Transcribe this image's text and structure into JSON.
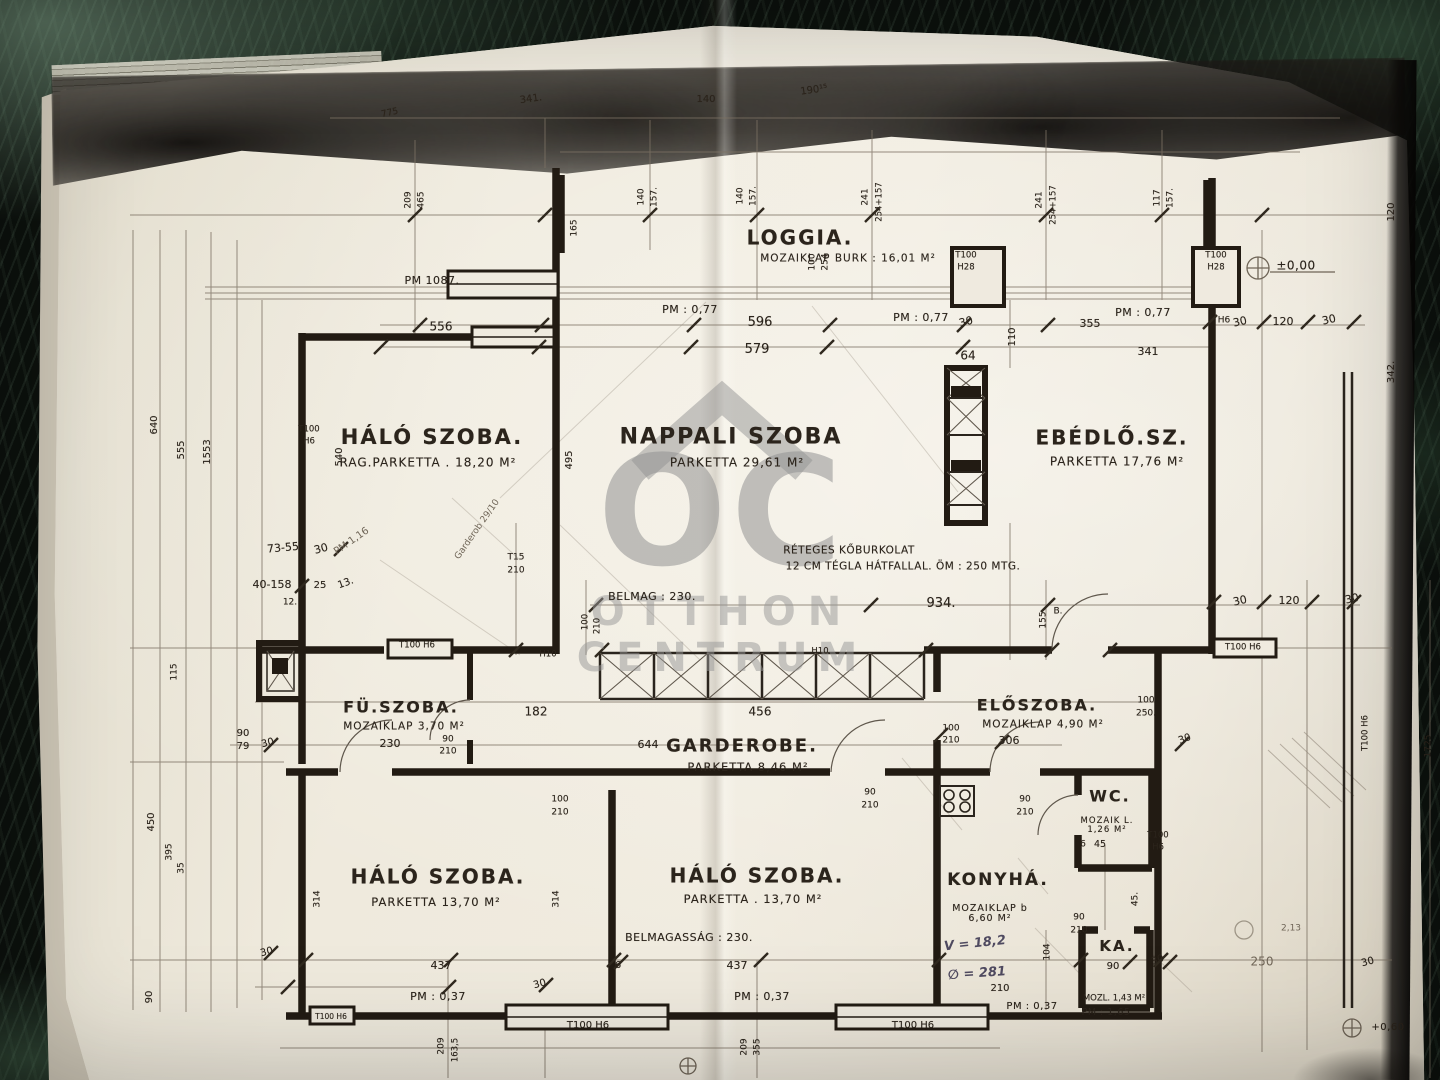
{
  "photo": {
    "surface": "dark green marble table",
    "document": "Hungarian apartment floor plan photocopy",
    "watermark": {
      "initials": "OC",
      "line1": "OTTHON",
      "line2": "CENTRUM"
    }
  },
  "colors": {
    "marble": "#0c110d",
    "paper": "#e9e4d6",
    "ink": "#2b241c",
    "pencil": "#6f6557",
    "handwriting": "#4f4a60",
    "watermark": "#929292"
  },
  "rooms": [
    {
      "name": "LOGGIA.",
      "finish": "MOZAIKLAP BURK : 16,01 M²",
      "nx": 800,
      "ny": 238,
      "ns": 20,
      "fx": 848,
      "fy": 259,
      "fs": 10.5
    },
    {
      "name": "HÁLÓ SZOBA.",
      "finish": "RAG.PARKETTA . 18,20 M²",
      "nx": 432,
      "ny": 437,
      "ns": 21,
      "fx": 428,
      "fy": 463,
      "fs": 12
    },
    {
      "name": "NAPPALI SZOBA",
      "finish": "PARKETTA 29,61 M²",
      "nx": 731,
      "ny": 437,
      "ns": 22,
      "fx": 737,
      "fy": 463,
      "fs": 12
    },
    {
      "name": "EBÉDLŐ.SZ.",
      "finish": "PARKETTA 17,76 M²",
      "nx": 1112,
      "ny": 438,
      "ns": 20,
      "fx": 1117,
      "fy": 462,
      "fs": 12
    },
    {
      "name": "FÜ.SZOBA.",
      "finish": "MOZAIKLAP 3,70 M²",
      "nx": 401,
      "ny": 708,
      "ns": 16,
      "fx": 404,
      "fy": 727,
      "fs": 10.5
    },
    {
      "name": "GARDEROBE.",
      "finish": "PARKETTA 8,46 M²",
      "nx": 742,
      "ny": 747,
      "ns": 18,
      "fx": 748,
      "fy": 767,
      "fs": 11.5
    },
    {
      "name": "ELŐSZOBA.",
      "finish": "MOZAIKLAP 4,90 M²",
      "nx": 1037,
      "ny": 706,
      "ns": 16,
      "fx": 1043,
      "fy": 725,
      "fs": 10.5
    },
    {
      "name": "WC.",
      "finish": "MOZAIK L. 1,26 M²",
      "nx": 1110,
      "ny": 797,
      "ns": 16,
      "fx": 1107,
      "fy": 826,
      "fs": 8.5,
      "fw": 62
    },
    {
      "name": "KONYHÁ.",
      "finish": "MOZAIKLAP b 6,60 M²",
      "nx": 998,
      "ny": 881,
      "ns": 17,
      "fx": 990,
      "fy": 914,
      "fs": 9.5,
      "fw": 86
    },
    {
      "name": "KA.",
      "finish": "",
      "nx": 1117,
      "ny": 947,
      "ns": 15
    },
    {
      "name": "HÁLÓ SZOBA.",
      "finish": "PARKETTA 13,70 M²",
      "nx": 438,
      "ny": 877,
      "ns": 20,
      "fx": 436,
      "fy": 902,
      "fs": 11.5
    },
    {
      "name": "HÁLÓ SZOBA.",
      "finish": "PARKETTA . 13,70 M²",
      "nx": 757,
      "ny": 876,
      "ns": 20,
      "fx": 753,
      "fy": 899,
      "fs": 11.5
    }
  ],
  "notes": [
    [
      "BELMAG : 230.",
      652,
      597,
      11
    ],
    [
      "BELMAGASSÁG : 230.",
      689,
      938,
      11
    ],
    [
      "RÉTEGES KŐBURKOLAT",
      849,
      551,
      10.5
    ],
    [
      "12 CM TÉGLA HÁTFALLAL. ÖM : 250 MTG.",
      903,
      567,
      10.5
    ]
  ],
  "levels": [
    [
      "±0,00",
      1296,
      266,
      12
    ],
    [
      "PM 1087.",
      432,
      281,
      11
    ],
    [
      "PM : 0,77",
      690,
      310,
      11
    ],
    [
      "PM : 0,77",
      921,
      318,
      11
    ],
    [
      "PM : 0,77",
      1143,
      313,
      11
    ],
    [
      "PM : 0,37",
      438,
      997,
      11
    ],
    [
      "PM : 0,37",
      762,
      997,
      11
    ],
    [
      "PM : 0,37",
      1032,
      1007,
      10
    ],
    [
      "PM : 1,65",
      1106,
      1013,
      9.5
    ],
    [
      "+0,60",
      1388,
      1028,
      10
    ]
  ],
  "dims": [
    [
      "596",
      760,
      323,
      13
    ],
    [
      "579",
      757,
      350,
      13
    ],
    [
      "556",
      441,
      327,
      12
    ],
    [
      "934.",
      941,
      604,
      13
    ],
    [
      "456",
      760,
      712,
      12
    ],
    [
      "182",
      536,
      712,
      12
    ],
    [
      "644",
      648,
      745,
      11
    ],
    [
      "230",
      390,
      744,
      11
    ],
    [
      "306",
      1009,
      741,
      11
    ],
    [
      "437",
      441,
      966,
      11
    ],
    [
      "437",
      737,
      966,
      11
    ],
    [
      "64",
      968,
      356,
      12
    ],
    [
      "30",
      966,
      322,
      11,
      -15
    ],
    [
      "355",
      1090,
      324,
      11
    ],
    [
      "341",
      1148,
      352,
      11
    ],
    [
      "110",
      1013,
      337,
      10,
      -90
    ],
    [
      "30",
      1240,
      322,
      11,
      -12
    ],
    [
      "120",
      1283,
      322,
      11
    ],
    [
      "30",
      1329,
      320,
      11,
      -12
    ],
    [
      "30",
      1240,
      601,
      11,
      -12
    ],
    [
      "120",
      1289,
      601,
      11
    ],
    [
      "30",
      1352,
      599,
      11,
      -12
    ],
    [
      "120",
      1392,
      212,
      10,
      -90
    ],
    [
      "342.",
      1392,
      372,
      10,
      -90
    ],
    [
      "341.",
      531,
      100,
      10,
      -8
    ],
    [
      "140",
      706,
      100,
      10
    ],
    [
      "190¹⁵",
      814,
      91,
      10,
      -8
    ],
    [
      "775",
      390,
      114,
      9,
      -12
    ],
    [
      "140",
      642,
      197,
      9,
      -90
    ],
    [
      "157.",
      655,
      197,
      9,
      -90
    ],
    [
      "140",
      741,
      196,
      9,
      -90
    ],
    [
      "157.",
      754,
      196,
      9,
      -90
    ],
    [
      "241",
      866,
      197,
      9,
      -90
    ],
    [
      "254+157",
      880,
      202,
      8.5,
      -90
    ],
    [
      "241",
      1040,
      200,
      9,
      -90
    ],
    [
      "254+157",
      1054,
      205,
      8.5,
      -90
    ],
    [
      "117",
      1158,
      198,
      9,
      -90
    ],
    [
      "157.",
      1171,
      198,
      9,
      -90
    ],
    [
      "209",
      409,
      200,
      9,
      -90
    ],
    [
      "465",
      422,
      200,
      9,
      -90
    ],
    [
      "165",
      575,
      228,
      9,
      -90
    ],
    [
      "100",
      813,
      262,
      9,
      -90
    ],
    [
      "254",
      826,
      262,
      9,
      -90
    ],
    [
      "T100",
      966,
      256,
      8.5
    ],
    [
      "H28",
      966,
      268,
      8.5
    ],
    [
      "T100",
      1216,
      256,
      8.5
    ],
    [
      "H28",
      1216,
      268,
      8.5
    ],
    [
      "H6",
      1224,
      321,
      9
    ],
    [
      "540",
      340,
      457,
      10,
      -90
    ],
    [
      "495",
      570,
      460,
      10,
      -90
    ],
    [
      "640",
      155,
      425,
      10,
      -90
    ],
    [
      "555",
      182,
      450,
      10,
      -90
    ],
    [
      "1553",
      208,
      452,
      10,
      -90
    ],
    [
      "T100",
      309,
      430,
      8.5
    ],
    [
      "H6",
      309,
      442,
      8.5
    ],
    [
      "73-55",
      283,
      548,
      11,
      -5
    ],
    [
      "30",
      321,
      549,
      11,
      -15
    ],
    [
      "40-158",
      272,
      585,
      11
    ],
    [
      "25",
      320,
      586,
      10
    ],
    [
      "13.",
      346,
      584,
      10,
      -20
    ],
    [
      "12.",
      290,
      603,
      9
    ],
    [
      "115",
      175,
      672,
      9,
      -90
    ],
    [
      "450",
      152,
      822,
      10,
      -90
    ],
    [
      "395",
      170,
      852,
      9,
      -90
    ],
    [
      "35",
      182,
      868,
      9,
      -90
    ],
    [
      "90",
      243,
      734,
      10
    ],
    [
      "79",
      243,
      747,
      10
    ],
    [
      "30",
      268,
      744,
      10,
      -15
    ],
    [
      "314",
      318,
      899,
      9,
      -90
    ],
    [
      "314",
      557,
      899,
      9,
      -90
    ],
    [
      "30",
      267,
      953,
      10,
      -15
    ],
    [
      "90",
      150,
      997,
      10,
      -90
    ],
    [
      "209",
      442,
      1046,
      9,
      -90
    ],
    [
      "163,5",
      456,
      1050,
      8.5,
      -90
    ],
    [
      "209",
      745,
      1047,
      9,
      -90
    ],
    [
      "355",
      758,
      1047,
      9,
      -90
    ],
    [
      "T100 H6",
      588,
      1026,
      10
    ],
    [
      "T100 H6",
      913,
      1026,
      10
    ],
    [
      "T100 H6",
      331,
      1017,
      7.5
    ],
    [
      "T100 H6",
      417,
      646,
      8.5
    ],
    [
      "T100 H6",
      1243,
      648,
      8.5
    ],
    [
      "H10",
      548,
      655,
      8.5
    ],
    [
      "H10",
      820,
      652,
      8.5
    ],
    [
      "T15",
      516,
      558,
      9
    ],
    [
      "210",
      516,
      571,
      9
    ],
    [
      "100",
      586,
      622,
      8.5,
      -90
    ],
    [
      "210",
      598,
      626,
      8.5,
      -90
    ],
    [
      "90",
      448,
      740,
      9
    ],
    [
      "210",
      448,
      752,
      9
    ],
    [
      "100",
      951,
      729,
      9
    ],
    [
      "210",
      951,
      741,
      9
    ],
    [
      "100",
      1146,
      701,
      9
    ],
    [
      "250.",
      1146,
      714,
      9
    ],
    [
      "30",
      1185,
      740,
      10,
      -20
    ],
    [
      "155",
      1044,
      620,
      9,
      -90
    ],
    [
      "B.",
      1058,
      612,
      9
    ],
    [
      "90",
      870,
      793,
      9
    ],
    [
      "210",
      870,
      806,
      9
    ],
    [
      "100",
      560,
      800,
      9
    ],
    [
      "210",
      560,
      813,
      9
    ],
    [
      "90",
      1025,
      800,
      9
    ],
    [
      "210",
      1025,
      813,
      9
    ],
    [
      "90",
      1079,
      918,
      9
    ],
    [
      "210",
      1079,
      931,
      9
    ],
    [
      "104",
      1048,
      952,
      9,
      -90
    ],
    [
      "210",
      1000,
      989,
      10
    ],
    [
      "90",
      1113,
      967,
      10
    ],
    [
      "30",
      1158,
      961,
      10,
      -20
    ],
    [
      "45.",
      1136,
      899,
      9,
      -90
    ],
    [
      "45",
      1100,
      845,
      9.5
    ],
    [
      "6",
      1083,
      845,
      9
    ],
    [
      "T100",
      1158,
      836,
      8.5
    ],
    [
      "H6",
      1158,
      848,
      8.5
    ],
    [
      "T100 H6",
      1366,
      733,
      8.5,
      -90
    ],
    [
      "1725",
      1429,
      746,
      9,
      -90
    ],
    [
      "30",
      540,
      985,
      10,
      -15
    ],
    [
      "6",
      618,
      966,
      10
    ],
    [
      "MOZL. 1,43 M²",
      1114,
      999,
      8.5
    ],
    [
      "30",
      1368,
      963,
      10,
      -15
    ]
  ],
  "pencil_texts": [
    [
      "250",
      1262,
      962,
      12
    ],
    [
      "2,13",
      1291,
      929,
      9
    ],
    [
      "PM 1,16",
      352,
      542,
      10,
      -35
    ],
    [
      "Garderob 29/10",
      478,
      530,
      9,
      -55
    ]
  ],
  "handwriting": [
    [
      "V = 18,2",
      975,
      944,
      13,
      -6
    ],
    [
      "∅ = 281",
      977,
      974,
      13,
      -4
    ]
  ]
}
